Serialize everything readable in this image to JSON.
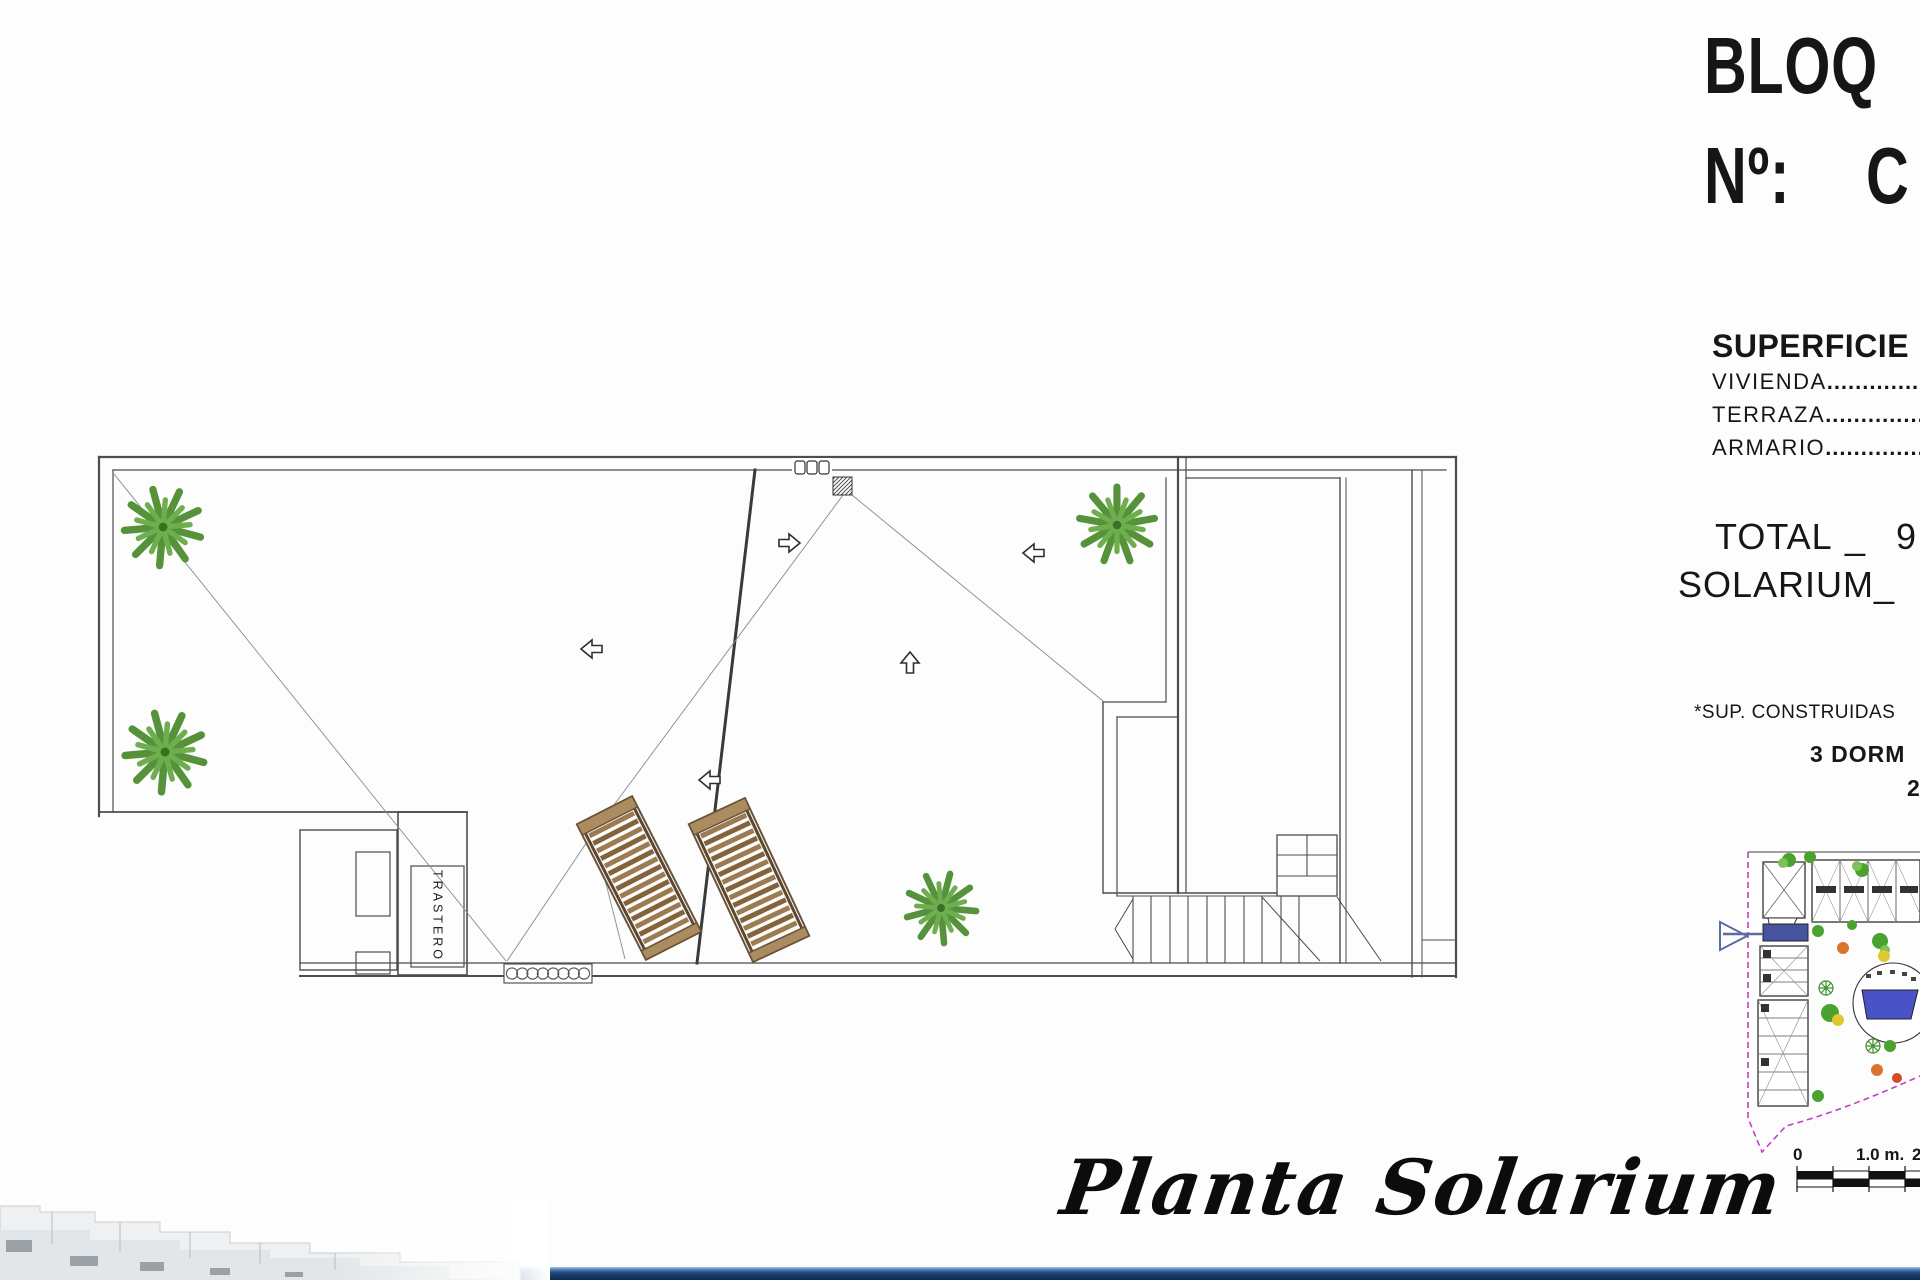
{
  "header": {
    "block_title": "BLOQ",
    "number_label": "Nº:",
    "number_value": "C"
  },
  "surfaces": {
    "title": "SUPERFICIE",
    "rows": [
      {
        "label": "VIVIENDA",
        "dots": "......................"
      },
      {
        "label": "TERRAZA",
        "dots": "......................"
      },
      {
        "label": "ARMARIO",
        "dots": "......................"
      }
    ],
    "total_label": "TOTAL",
    "total_separator": "_",
    "total_value_partial": "9",
    "solarium_label": "SOLARIUM",
    "solarium_separator": "_"
  },
  "notes": {
    "construction_note": "*SUP. CONSTRUIDAS",
    "bedrooms_partial": "3 DORM",
    "bathrooms_partial": "2"
  },
  "plan": {
    "storage_room_label": "TRASTERO",
    "caption": "Planta Solarium"
  },
  "scale_bar": {
    "start": "0",
    "middle": "1.0 m.",
    "end_partial": "2"
  },
  "icons": {
    "palm": "palm-tree-top-view",
    "lounger": "sun-lounger",
    "arrow": "hollow-direction-arrow",
    "drain": "hatched-roof-drain",
    "grille": "vent-grille",
    "pointer": "unit-location-pointer"
  },
  "colors": {
    "wall": "#4d4d4d",
    "palm_green": "#55923a",
    "lounger_brown": "#8a6b44",
    "site_boundary_magenta": "#c43fc4",
    "unit_highlight_blue": "#46549f",
    "pool_blue": "#4a52c8",
    "footer_navy": "#10294f"
  }
}
